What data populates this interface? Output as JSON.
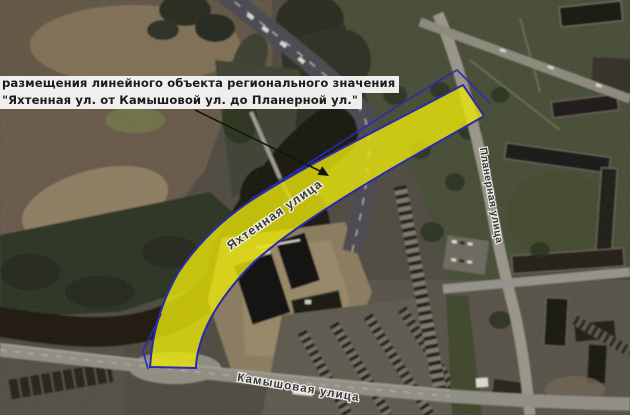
{
  "annotation": {
    "line1": "размещения линейного объекта регионального значения",
    "line2": "\"Яхтенная ул. от Камышовой ул. до Планерной ул.\""
  },
  "street_labels": {
    "yakhtennaya": "Яхтенная улица",
    "planernaya": "Планерная улица",
    "kamyshovaya": "Камышовая улица"
  },
  "zone": {
    "description": "planned-linear-object-corridor",
    "fill_color": "#eae60a",
    "outline_color": "#2a2ab0"
  }
}
